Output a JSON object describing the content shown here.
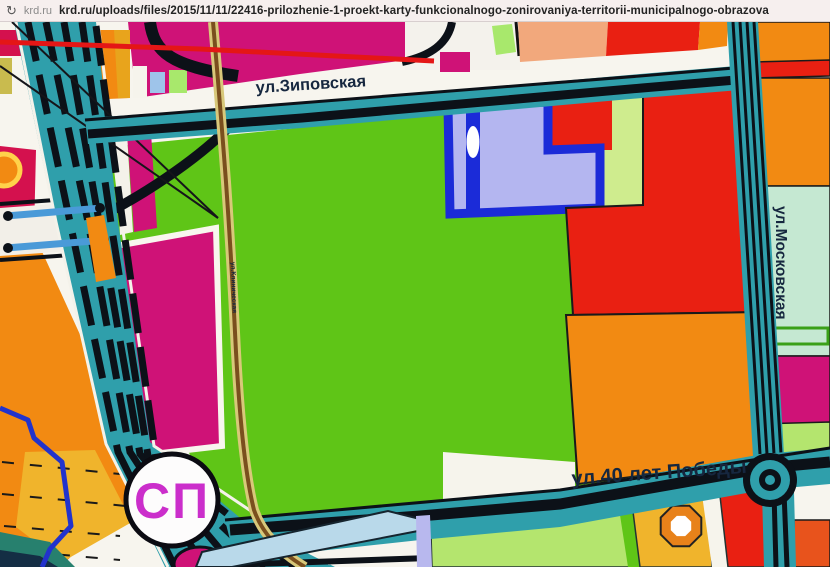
{
  "browser": {
    "reload_icon": "↻",
    "site": "krd.ru",
    "url": "krd.ru/uploads/files/2015/11/11/22416-prilozhenie-1-proekt-karty-funkcionalnogo-zonirovaniya-territorii-municipalnogo-obrazova"
  },
  "map": {
    "streets": {
      "top": "ул.Зиповская",
      "right": "ул.Московская",
      "bottom": "ул.40 лет Победы",
      "small": "ул.Клиническая"
    },
    "marker": {
      "label": "СП"
    },
    "palette": {
      "green_zone": "#5fc517",
      "road_teal": "#2f9fab",
      "road_stripe": "#0c1118",
      "magenta_zone": "#cf1277",
      "crimson_zone": "#d4114e",
      "red_zone": "#e92012",
      "orange_zone": "#f28a12",
      "amber_zone": "#f0b42c",
      "salmon_zone": "#f2a87c",
      "lavender_zone": "#b4b6f0",
      "blue_outline": "#1b2bd8",
      "pale_lime_zone": "#cfec8e",
      "mint_zone": "#c5e8d2",
      "light_green_zone": "#b4e56e",
      "river_blue": "#2233cc",
      "rail_brown": "#7a4f1e",
      "label_navy": "#16273f",
      "sp_magenta": "#cb2ecb"
    }
  }
}
